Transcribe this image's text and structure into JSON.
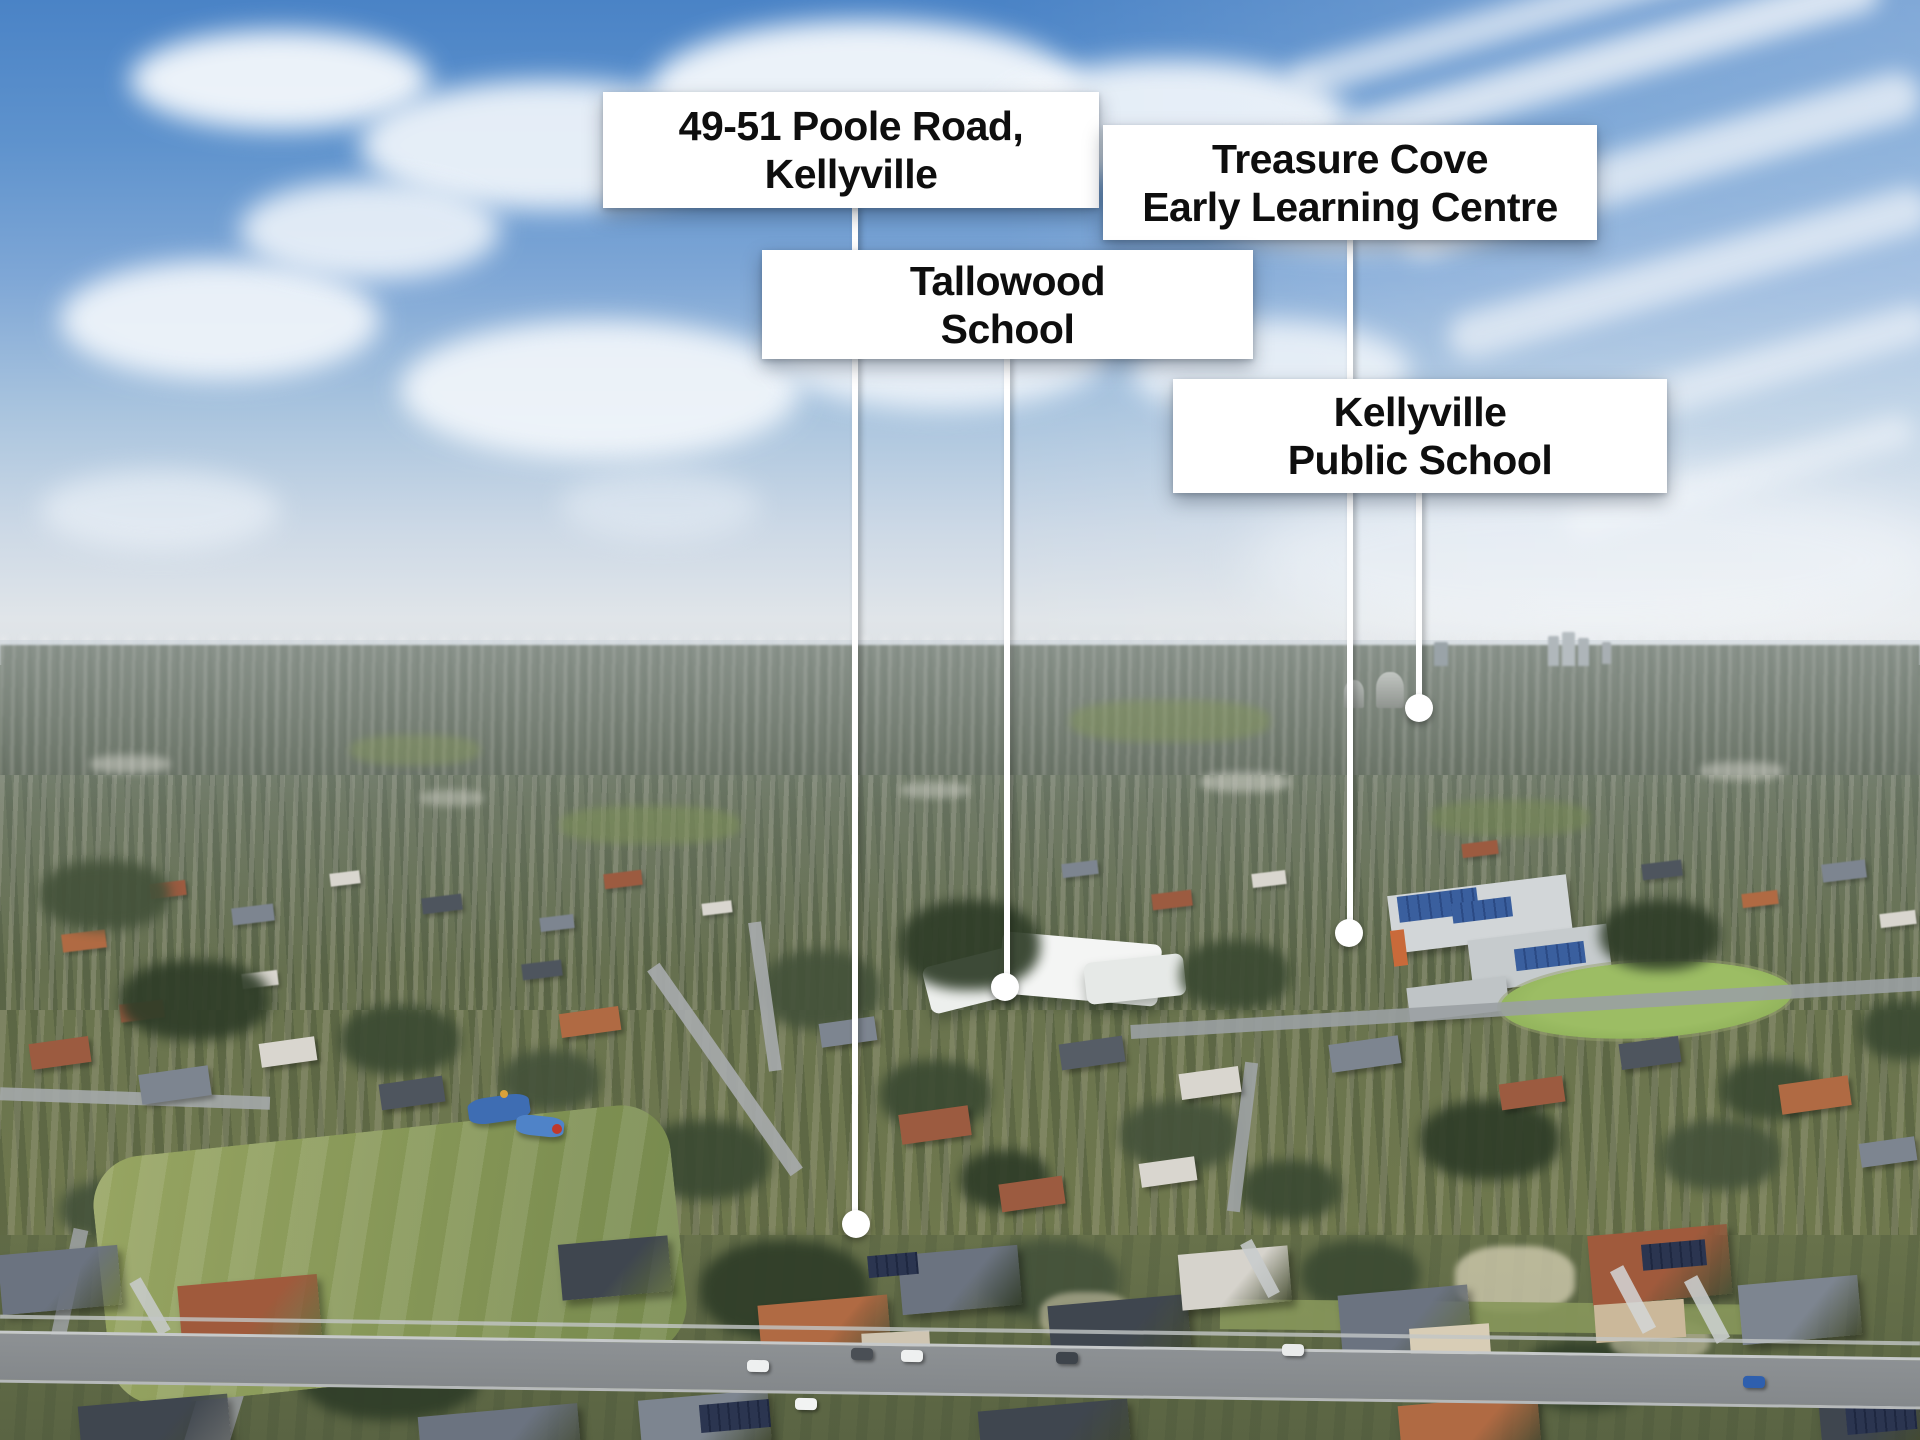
{
  "scene": {
    "type": "aerial-suburb-photo",
    "palette": {
      "sky_top": "#4a83c6",
      "sky_horizon": "#dde1e4",
      "cloud": "#f4f8fc",
      "distant_suburb": "#59624f",
      "mid_suburb": "#68724f",
      "grass_field": "#8a9a5b",
      "sports_oval": "#8fb25a",
      "road": "#8d9194",
      "roof_terracotta": "#9c5b40",
      "roof_gray": "#7d8590",
      "solar_panel": "#2b3550"
    }
  },
  "style": {
    "label_bg": "#ffffff",
    "label_text": "#0e0e0e",
    "leader_color": "#ffffff",
    "marker_color": "#ffffff"
  },
  "annotations": [
    {
      "id": "property-address",
      "label_lines": [
        "49-51 Poole Road,",
        "Kellyville"
      ],
      "marker": {
        "x": 856,
        "y": 1224
      }
    },
    {
      "id": "treasure-cove-elc",
      "label_lines": [
        "Treasure Cove",
        "Early Learning Centre"
      ],
      "marker": {
        "x": 1349,
        "y": 933
      }
    },
    {
      "id": "tallowood-school",
      "label_lines": [
        "Tallowood",
        "School"
      ],
      "marker": {
        "x": 1005,
        "y": 987
      }
    },
    {
      "id": "kellyville-public-school",
      "label_lines": [
        "Kellyville",
        "Public School"
      ],
      "marker": {
        "x": 1419,
        "y": 708
      }
    }
  ]
}
